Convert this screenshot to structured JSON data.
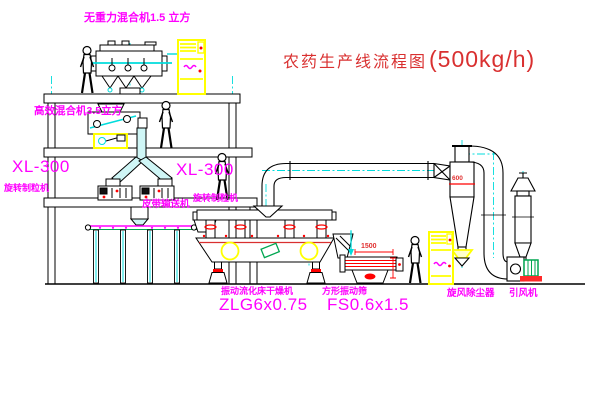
{
  "title": {
    "name": "农药生产线流程图",
    "capacity": "(500kg/h)"
  },
  "labels": {
    "no_gravity_mixer": "无重力混合机1.5 立方",
    "high_efficiency_mixer": "高效混合机3.5立方",
    "granulator_left_model": "XL-300",
    "granulator_left_name": "旋转制粒机",
    "granulator_right_model": "XL-300",
    "granulator_right_name": "旋转制粒机",
    "belt_conveyor": "皮带输送机",
    "dryer_name": "振动流化床干燥机",
    "dryer_model": "ZLG6x0.75",
    "screen_name": "方形振动筛",
    "screen_model": "FS0.6x1.5",
    "cyclone_name": "旋风除尘器",
    "fan_name": "引风机"
  },
  "dimensions": {
    "cyclone_inlet": "600",
    "screen_length": "1500"
  },
  "colors": {
    "line": "#000000",
    "centerline_cyan": "#00DCDC",
    "label_magenta": "#FF00FF",
    "title_red": "#D93030",
    "cabinet_yellow": "#FFFF00",
    "accent_red": "#FF0000",
    "motor_green": "#00A650"
  }
}
